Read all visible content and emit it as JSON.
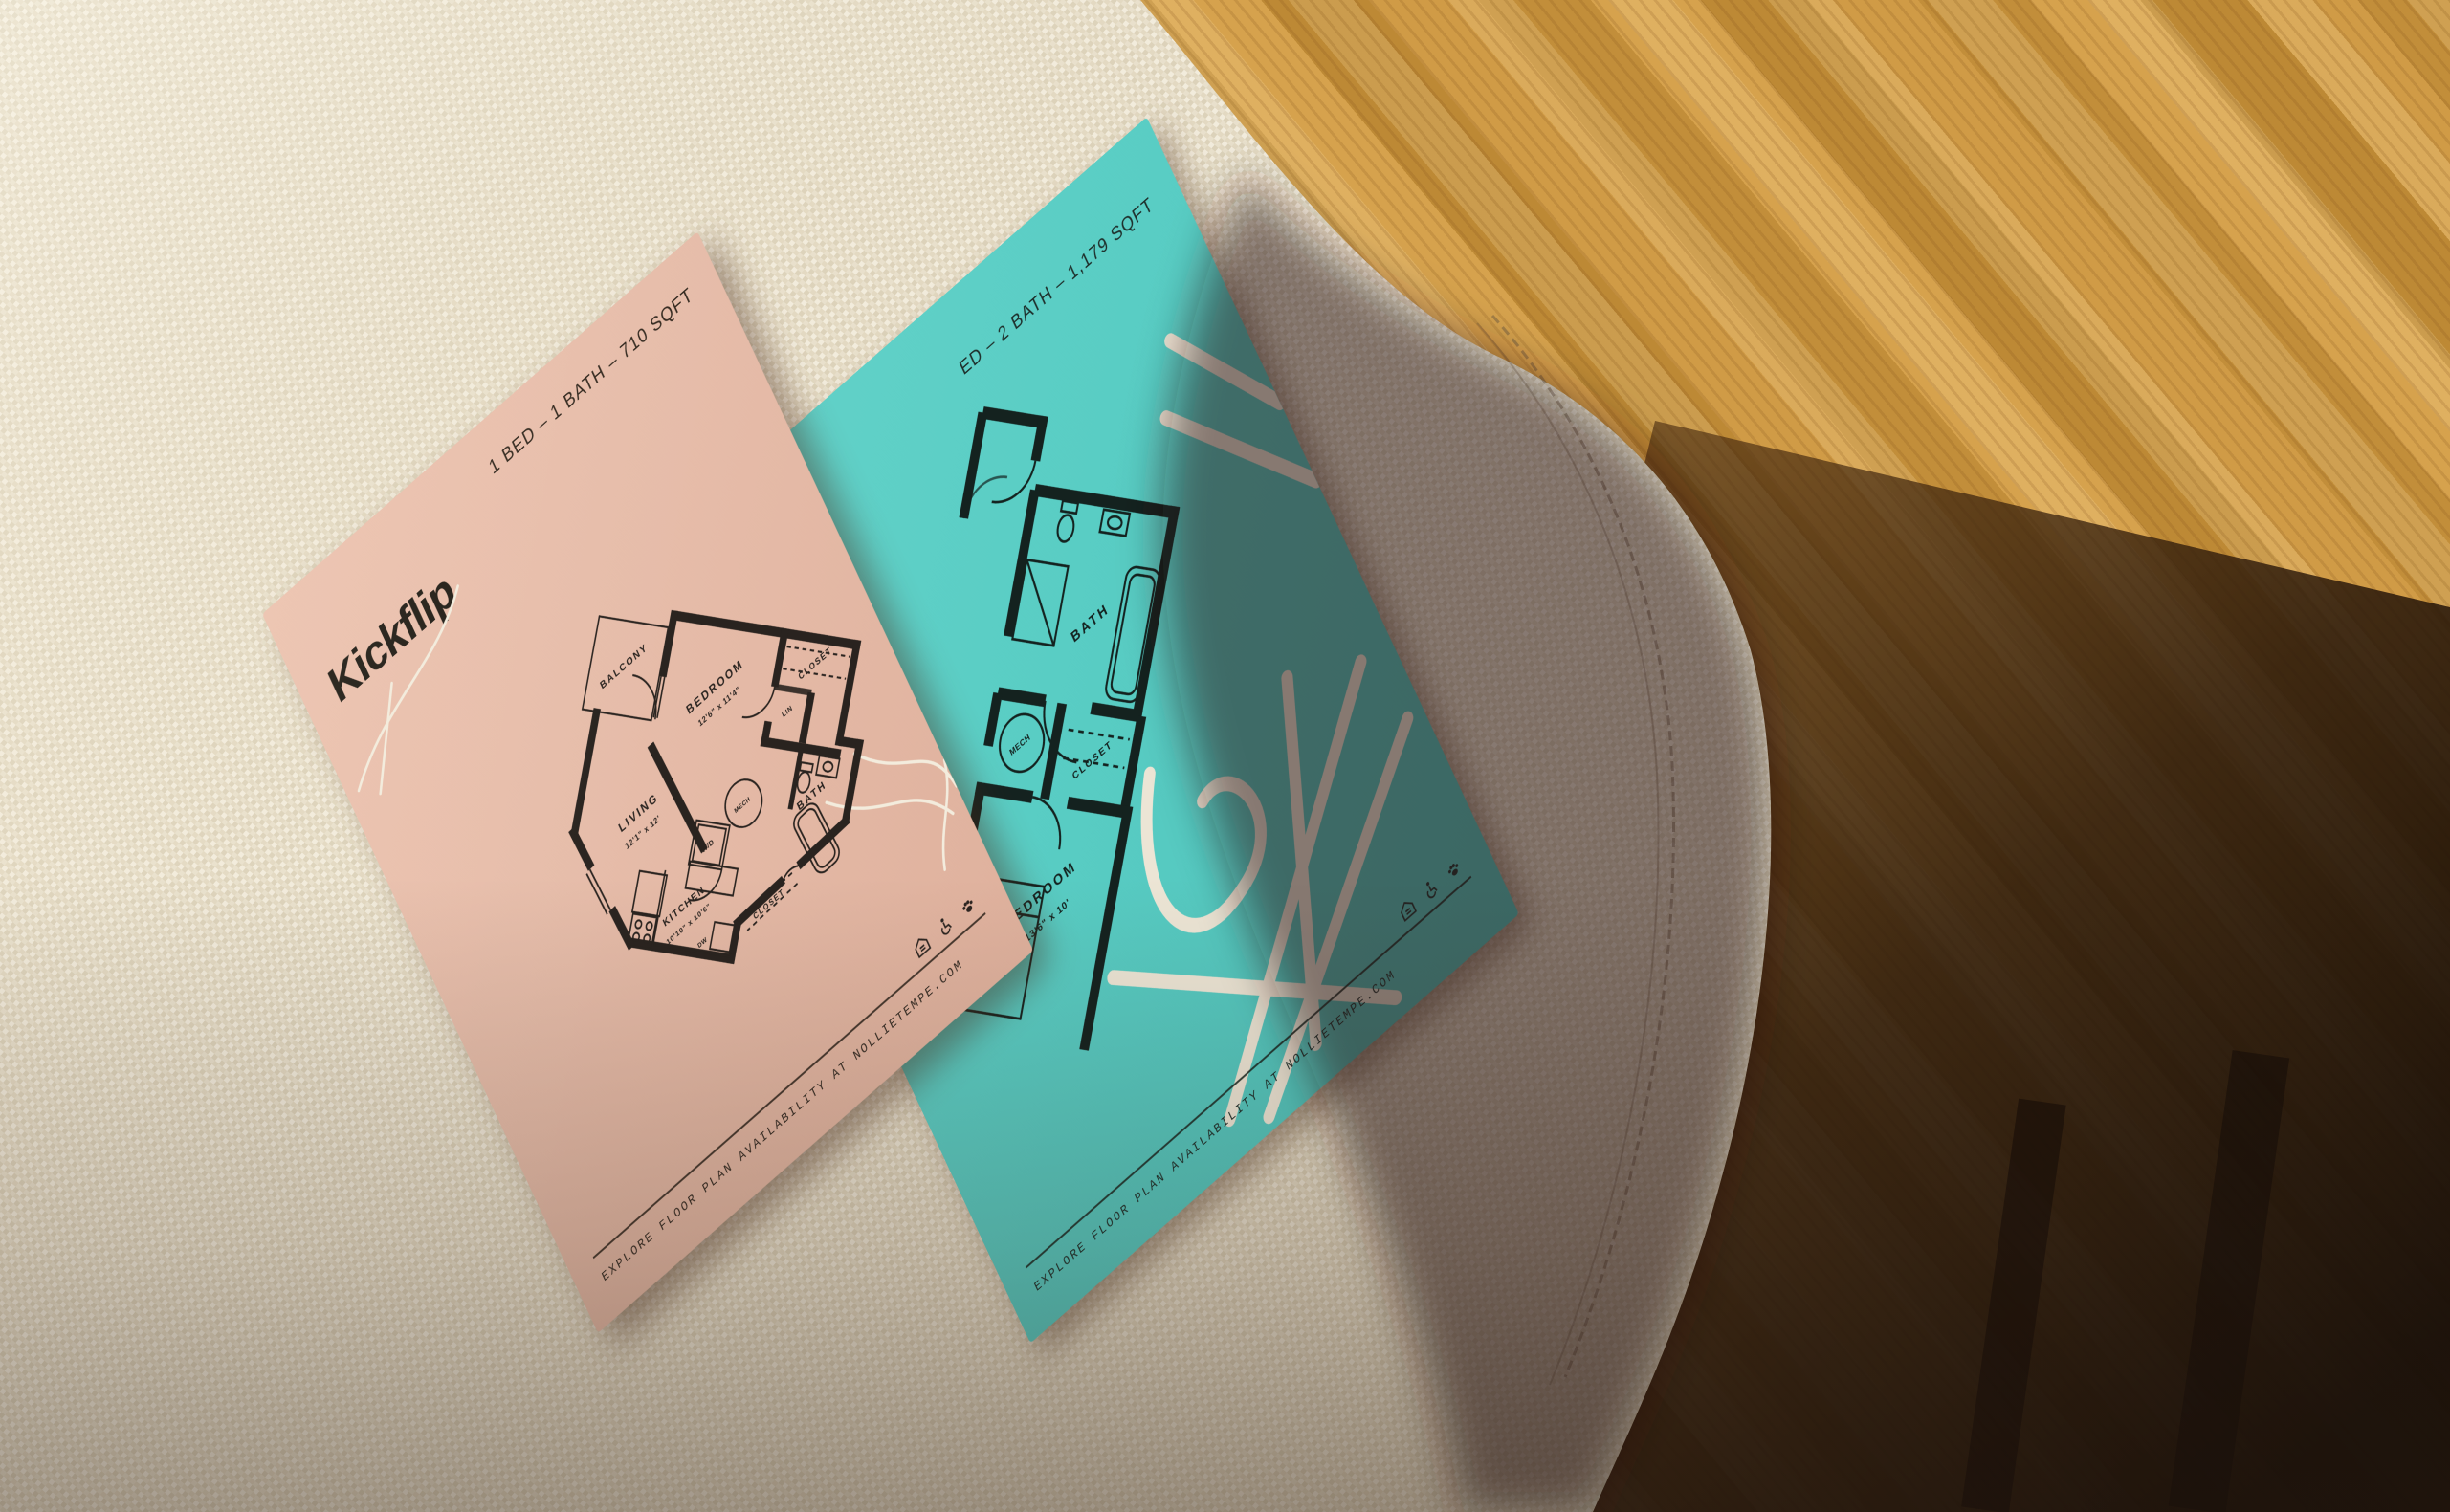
{
  "colors": {
    "wood_lit": "#d09b46",
    "wood_shadow": "#2a1708",
    "fabric": "#e9e1cd",
    "fabric_shadow": "#6f6354",
    "pink_paper": "#e6bca9",
    "teal_paper": "#59cdc4",
    "ink": "#29231f",
    "decoration_white": "#efe8d8"
  },
  "pink_flyer": {
    "header": "1 BED – 1 BATH – 710 SQFT",
    "logo": "Kickflip",
    "rooms": {
      "balcony": "BALCONY",
      "bedroom": "BEDROOM",
      "bedroom_dims": "12'6\" x 11'4\"",
      "closet": "CLOSET",
      "lin": "LIN",
      "bath": "BATH",
      "mech": "MECH",
      "wd": "W/D",
      "living": "LIVING",
      "living_dims": "12'1\" x 12'",
      "kitchen": "KITCHEN",
      "kitchen_dims": "10'10\" x 10'6\"",
      "dw": "DW",
      "entry_closet": "CLOSET"
    },
    "footer_url": "EXPLORE FLOOR PLAN AVAILABILITY AT NOLLIETEMPE.COM",
    "footer_icons": [
      "equal-housing",
      "accessibility",
      "pet-friendly"
    ]
  },
  "teal_flyer": {
    "header": "ED – 2 BATH – 1,179 SQFT",
    "rooms": {
      "bath": "BATH",
      "mech": "MECH",
      "closet": "CLOSET",
      "bedroom": "BEDROOM",
      "bedroom_dims": "13'6\" x 10'"
    },
    "footer_url": "EXPLORE FLOOR PLAN AVAILABILITY AT NOLLIETEMPE.COM",
    "footer_icons": [
      "equal-housing",
      "accessibility",
      "pet-friendly"
    ]
  }
}
